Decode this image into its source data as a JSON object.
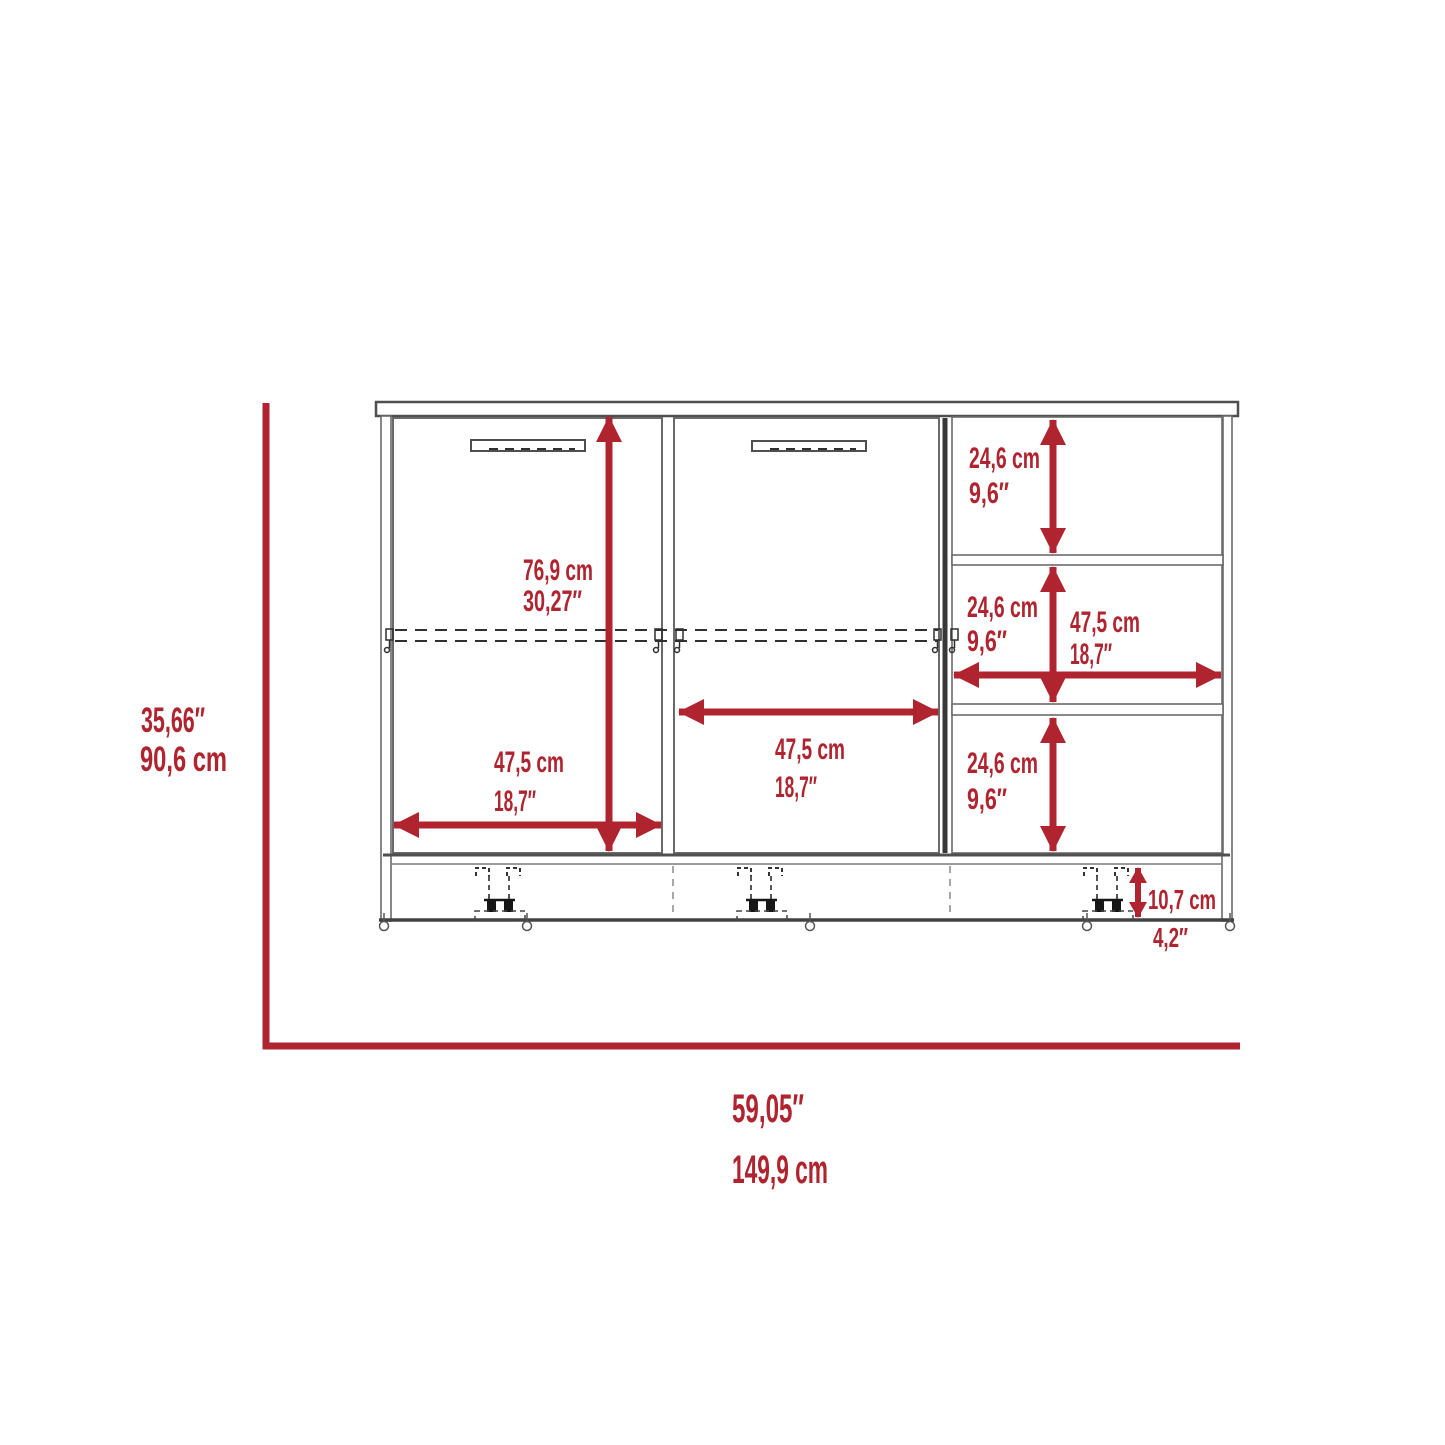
{
  "colors": {
    "dimension_red": "#B0242F",
    "outline_dark": "#4A4A4A",
    "outline_light": "#8A8A8A",
    "background": "#FFFFFF"
  },
  "dimensions": {
    "overall_height": {
      "in": "35,66″",
      "cm": "90,6 cm"
    },
    "overall_width": {
      "in": "59,05″",
      "cm": "149,9 cm"
    },
    "door_opening_height": {
      "cm": "76,9 cm",
      "in": "30,27″"
    },
    "left_door_width": {
      "cm": "47,5 cm",
      "in": "18,7″"
    },
    "middle_door_width": {
      "cm": "47,5 cm",
      "in": "18,7″"
    },
    "shelf_top_compartment_height": {
      "cm": "24,6 cm",
      "in": "9,6″"
    },
    "shelf_middle_compartment_height": {
      "cm": "24,6 cm",
      "in": "9,6″"
    },
    "shelf_compartment_width": {
      "cm": "47,5 cm",
      "in": "18,7″"
    },
    "shelf_bottom_compartment_height": {
      "cm": "24,6 cm",
      "in": "9,6″"
    },
    "base_height": {
      "cm": "10,7 cm",
      "in": "4,2″"
    }
  }
}
